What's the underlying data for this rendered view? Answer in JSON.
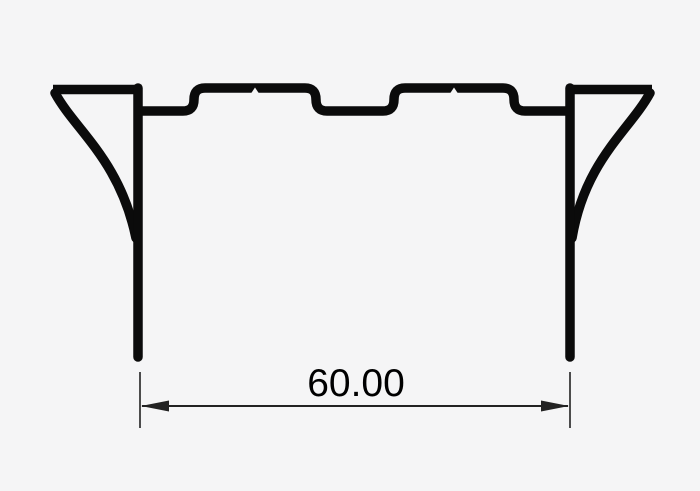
{
  "drawing": {
    "dimension": {
      "value": "60.00"
    },
    "colors": {
      "background": "#f5f5f6",
      "profile_line": "#0b0b0b",
      "dimension_line": "#222222",
      "text": "#000000"
    }
  }
}
